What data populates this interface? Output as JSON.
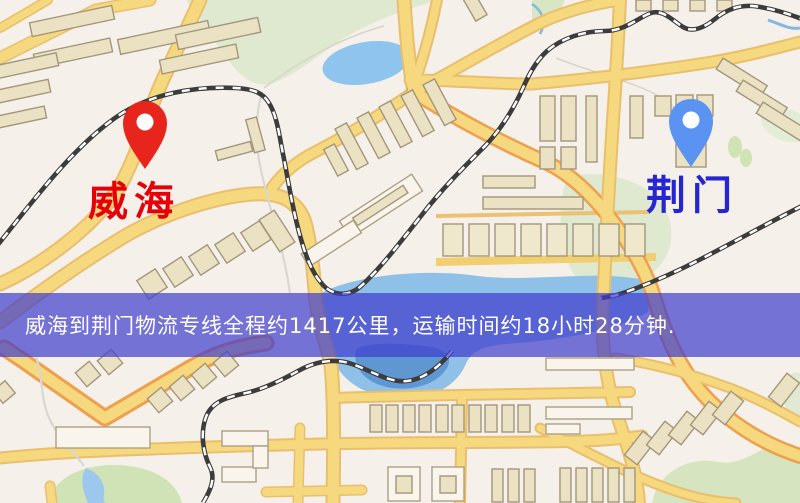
{
  "map": {
    "background_color": "#f6f0ea",
    "road_color": "#f6d87e",
    "water_color": "#8fc0e8",
    "green_color": "#dfe9d0",
    "origin": {
      "label": "威海",
      "label_color": "#e60008",
      "pin_color": "#e8251c"
    },
    "destination": {
      "label": "荆门",
      "label_color": "#2525d2",
      "pin_color": "#5b93f2"
    }
  },
  "banner": {
    "text": "威海到荆门物流专线全程约1417公里，运输时间约18小时28分钟.",
    "text_color": "#ffffff",
    "overlay_color": "#3e3ccd",
    "origin": "威海",
    "destination": "荆门",
    "distance_km": "1417",
    "duration": "18小时28分钟"
  }
}
